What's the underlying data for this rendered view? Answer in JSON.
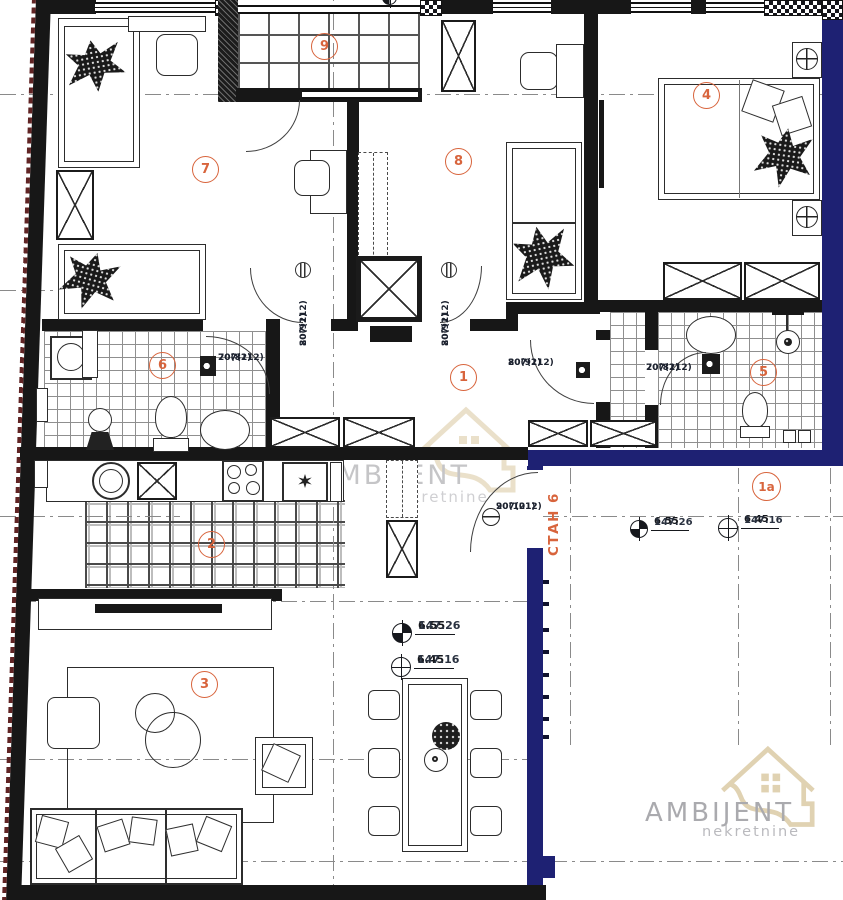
{
  "apartment_label": "СТАН 6",
  "rooms": [
    {
      "number": "1"
    },
    {
      "number": "1a"
    },
    {
      "number": "2"
    },
    {
      "number": "3"
    },
    {
      "number": "4"
    },
    {
      "number": "5"
    },
    {
      "number": "6"
    },
    {
      "number": "7"
    },
    {
      "number": "8"
    },
    {
      "number": "9"
    }
  ],
  "doors": [
    {
      "width": "80(91)",
      "height": "207(212)",
      "location": "room-7"
    },
    {
      "width": "80(91)",
      "height": "207(212)",
      "location": "room-8"
    },
    {
      "width": "70(81)",
      "height": "207(212)",
      "location": "room-6-bathroom"
    },
    {
      "width": "80(91)",
      "height": "207(212)",
      "location": "hall-to-wing"
    },
    {
      "width": "70(81)",
      "height": "207(212)",
      "location": "room-5-bathroom"
    },
    {
      "width": "90(101)",
      "height": "207(212)",
      "location": "entrance"
    }
  ],
  "elevation_markers": [
    {
      "level": "6.55",
      "absolute": "147.26",
      "symbol": "filled",
      "location": "hallway-1a"
    },
    {
      "level": "6.45",
      "absolute": "147.16",
      "symbol": "open",
      "location": "hallway-1a"
    },
    {
      "level": "6.55",
      "absolute": "147.26",
      "symbol": "filled",
      "location": "living-room"
    },
    {
      "level": "6.45",
      "absolute": "147.16",
      "symbol": "open",
      "location": "living-room"
    },
    {
      "level": "6.55",
      "absolute": "147.26",
      "symbol": "filled",
      "location": "top-edge-cropped"
    }
  ],
  "watermark": {
    "brand": "AMBIJENT",
    "subtitle": "nekretnine"
  },
  "colors": {
    "wall": "#171717",
    "boundary": "#1e2173",
    "room_number": "#d8643c",
    "label": "#1d2330",
    "watermark_house": "#d9c7a0",
    "watermark_text": "#96969b",
    "watermark_subtitle": "#a9a9af",
    "tile_line": "#8f8f8f",
    "dash_line": "#8a8a8a"
  }
}
